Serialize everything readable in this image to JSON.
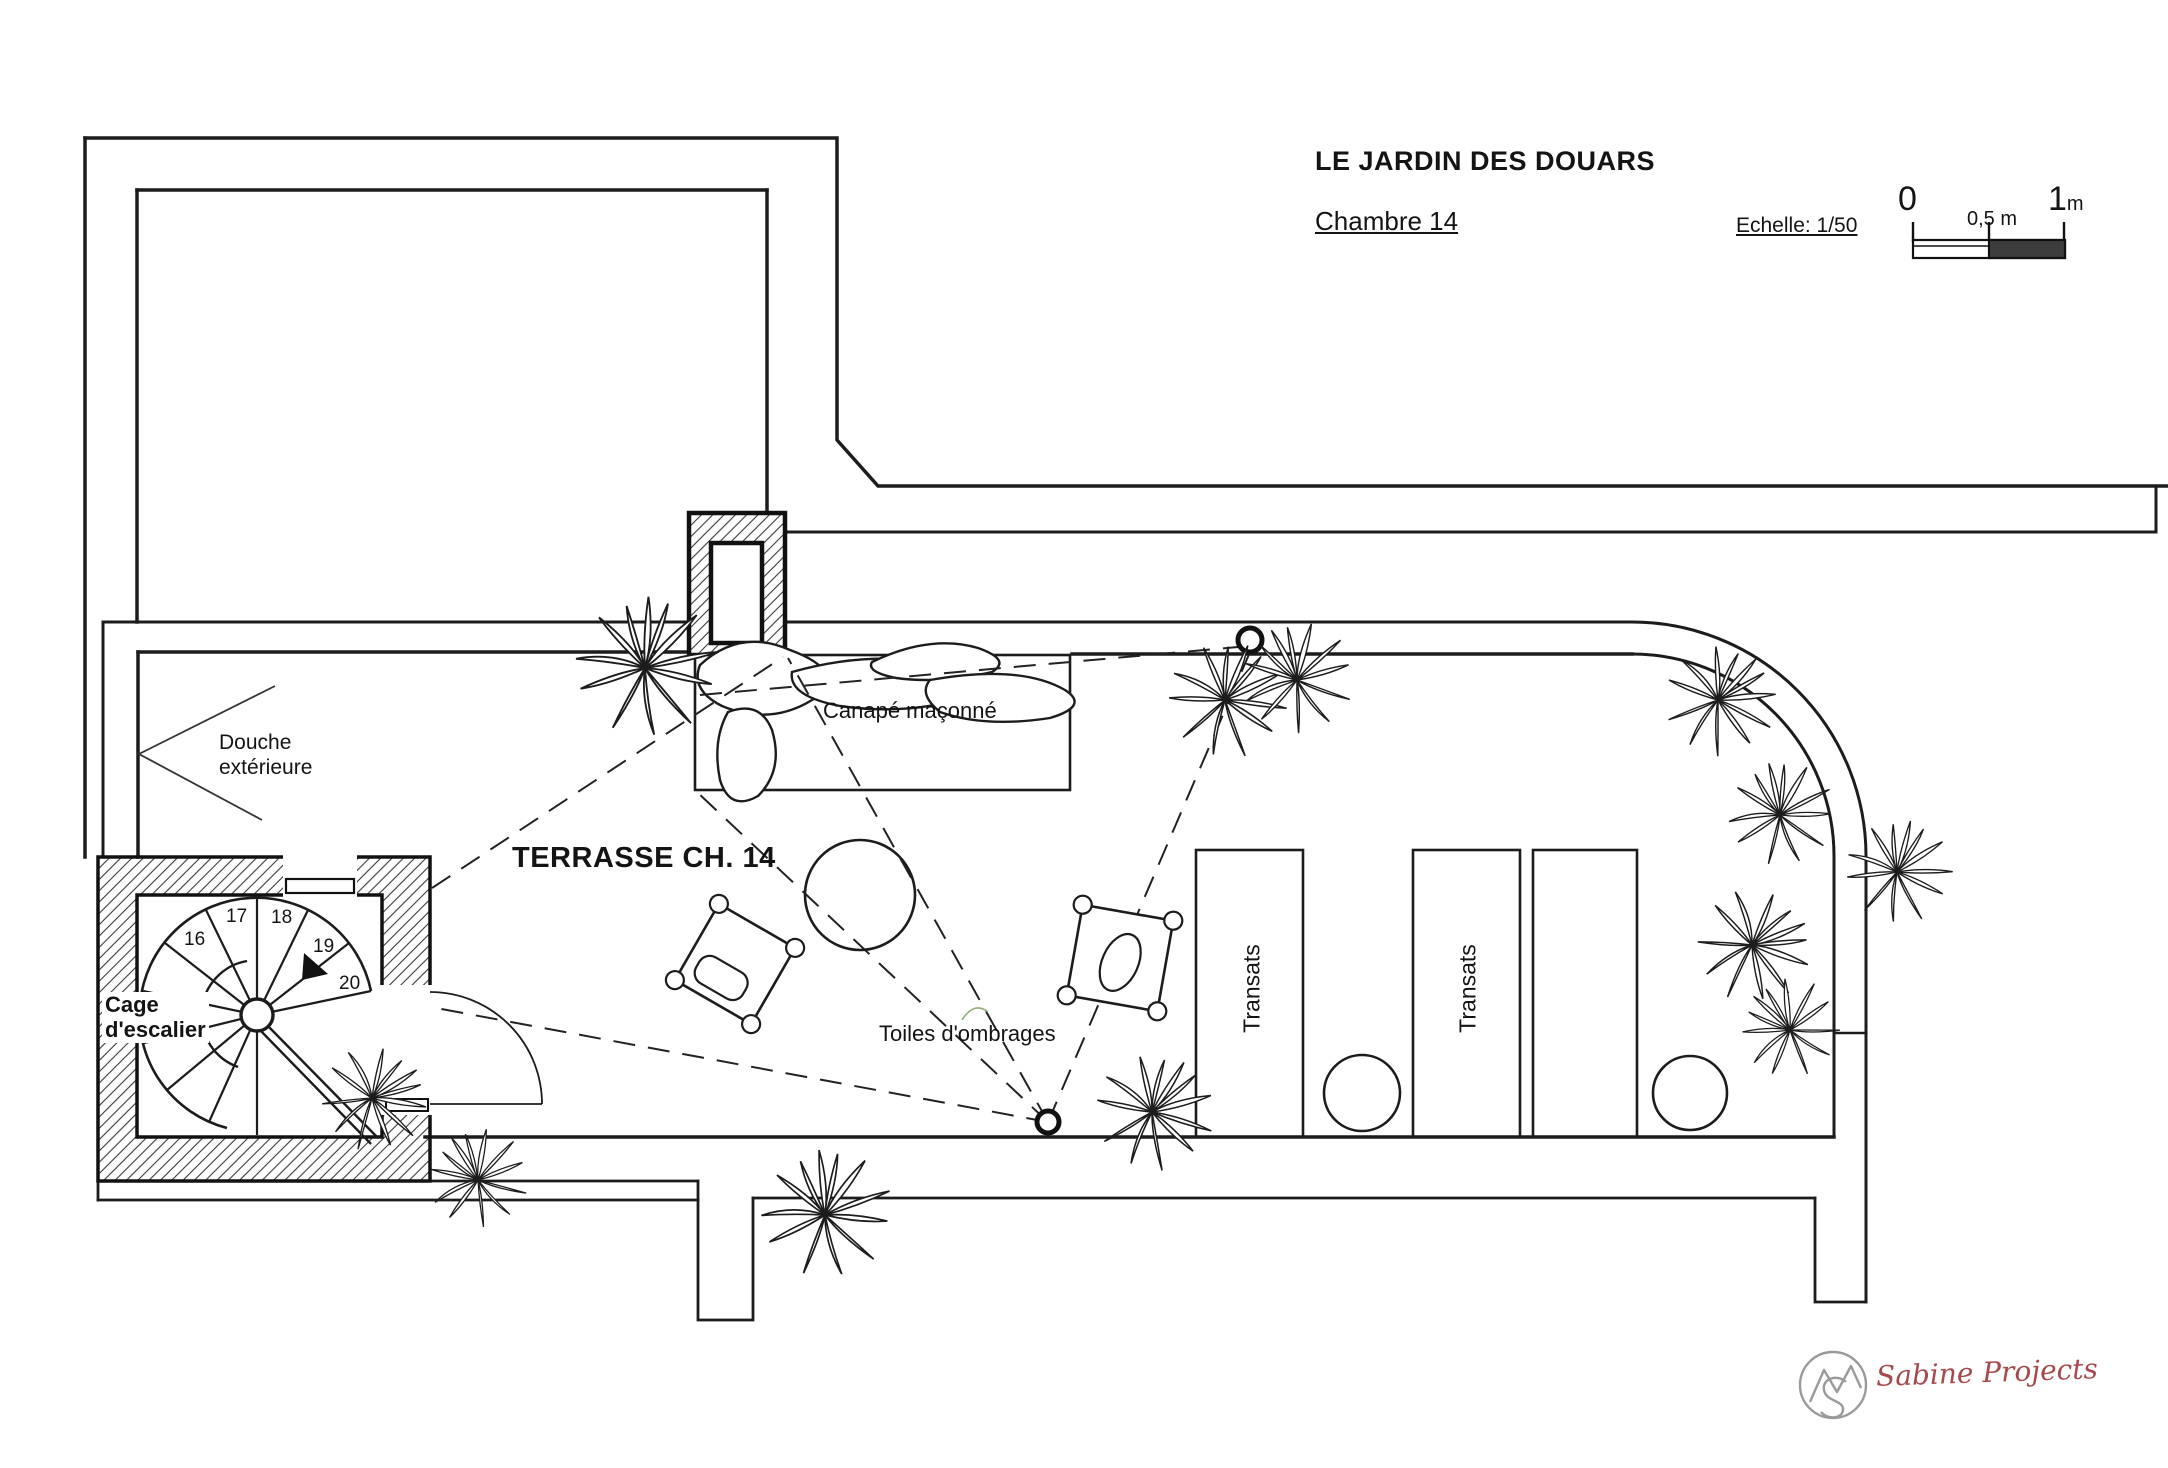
{
  "title_block": {
    "title": "LE JARDIN DES DOUARS",
    "subtitle": "Chambre 14",
    "scale_label": "Echelle: 1/50",
    "scale_bar": {
      "zero": "0",
      "half": "0,5 m",
      "one": "1",
      "one_unit": "m"
    }
  },
  "plan": {
    "room_label": "TERRASSE CH. 14",
    "labels": {
      "canape": "Canapé maçonné",
      "douche_line1": "Douche",
      "douche_line2": "extérieure",
      "cage_line1": "Cage",
      "cage_line2": "d'escalier",
      "toiles": "Toiles d'ombrages",
      "transat_1": "Transats",
      "transat_2": "Transats"
    },
    "stair_numbers": [
      "16",
      "17",
      "18",
      "19",
      "20"
    ]
  },
  "footer": {
    "logo_text": "Sabine Projects"
  },
  "colors": {
    "line": "#1c1c1c",
    "scale_fill": "#3d3d3d",
    "logo_text": "#a5494d",
    "logo_mark": "#9a9a9a",
    "accent_green": "#8fae7a"
  }
}
